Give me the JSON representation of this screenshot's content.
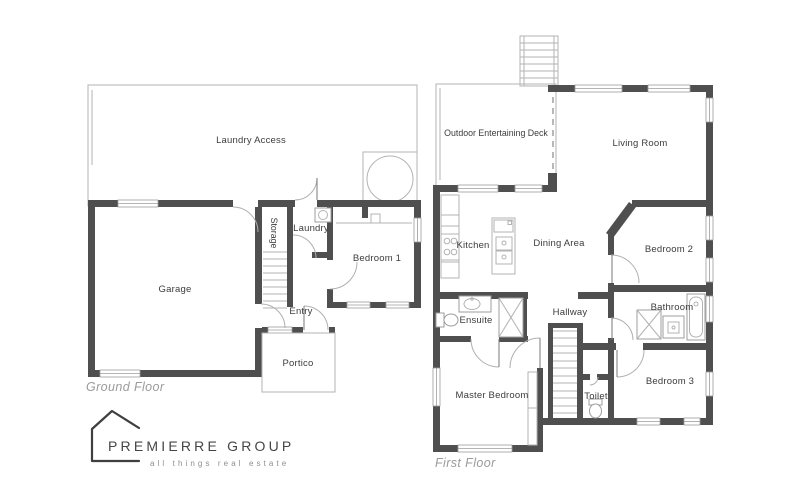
{
  "ground_floor": {
    "title": "Ground Floor",
    "rooms": {
      "laundry_access": "Laundry Access",
      "storage": "Storage",
      "laundry": "Laundry",
      "bedroom1": "Bedroom 1",
      "garage": "Garage",
      "entry": "Entry",
      "portico": "Portico"
    }
  },
  "first_floor": {
    "title": "First Floor",
    "rooms": {
      "deck": "Outdoor Entertaining Deck",
      "living_room": "Living Room",
      "kitchen": "Kitchen",
      "dining": "Dining Area",
      "bedroom2": "Bedroom 2",
      "ensuite": "Ensuite",
      "hallway": "Hallway",
      "bathroom": "Bathroom",
      "master_bedroom": "Master Bedroom",
      "toilet": "Toilet",
      "bedroom3": "Bedroom 3"
    }
  },
  "logo": {
    "name": "PREMIERRE GROUP",
    "tagline": "all things real estate"
  },
  "colors": {
    "wall": "#4f4f4f",
    "thin_line": "#b3b3b3",
    "room_label": "#3c3c3c",
    "floor_label": "#9b9b9b"
  }
}
